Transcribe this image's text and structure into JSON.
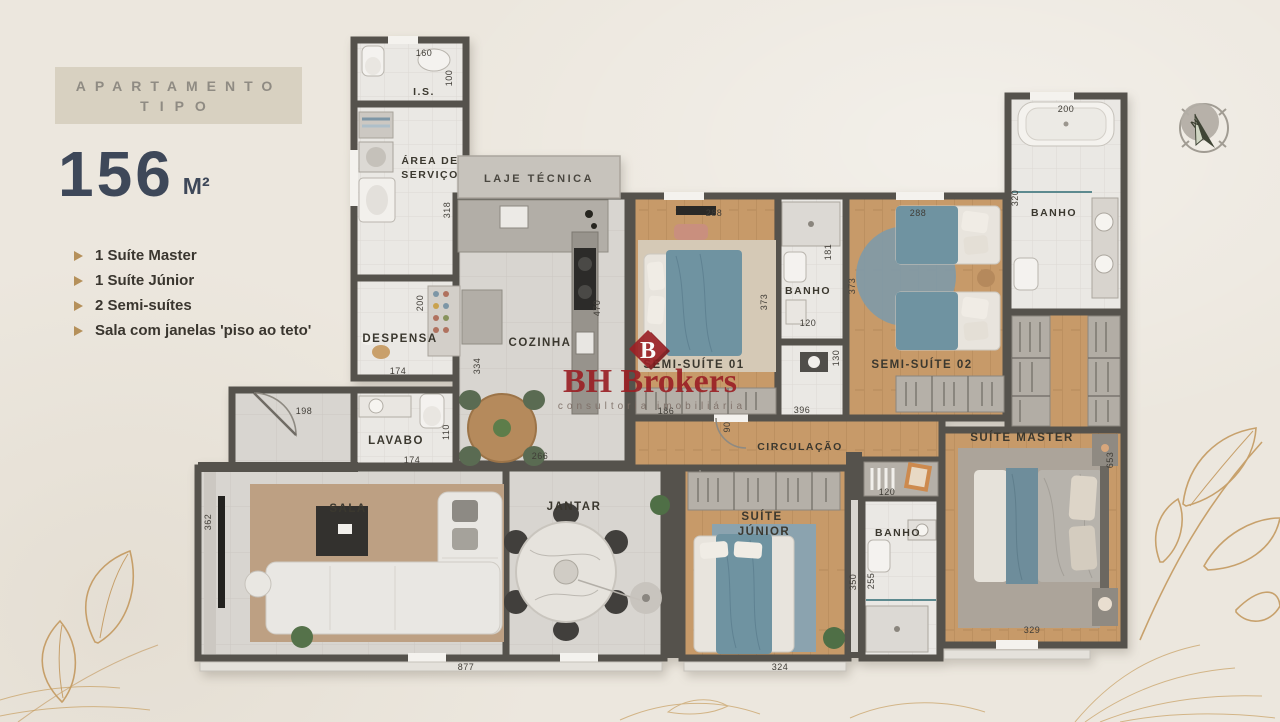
{
  "sidebar": {
    "banner": {
      "line1": "APARTAMENTO",
      "line2": "TIPO"
    },
    "area": {
      "value": "156",
      "unit": "M²"
    },
    "features": [
      {
        "label": "1 Suíte Master"
      },
      {
        "label": "1 Suíte Júnior"
      },
      {
        "label": "2 Semi-suítes"
      },
      {
        "label": "Sala com janelas 'piso ao teto'"
      }
    ]
  },
  "logo": {
    "monogram": "B",
    "name": "BH Brokers",
    "tagline": "consultoria imobiliária"
  },
  "compass": {
    "north": "N"
  },
  "plan": {
    "rooms": {
      "is": "I.S.",
      "area_servico_1": "ÁREA DE",
      "area_servico_2": "SERVIÇO",
      "laje_tecnica": "LAJE TÉCNICA",
      "despensa": "DESPENSA",
      "cozinha": "COZINHA",
      "lavabo": "LAVABO",
      "sala": "SALA",
      "jantar": "JANTAR",
      "semi_suite_01": "SEMI-SUÍTE 01",
      "semi_suite_02": "SEMI-SUÍTE 02",
      "banho_semi": "BANHO",
      "banho_master": "BANHO",
      "banho_junior": "BANHO",
      "circulacao": "CIRCULAÇÃO",
      "suite_master": "SUÍTE MASTER",
      "suite_junior_1": "SUÍTE",
      "suite_junior_2": "JÚNIOR"
    },
    "dimensions": {
      "is_width": "160",
      "is_depth": "100",
      "servico_height": "318",
      "despensa_height": "200",
      "despensa_width": "174",
      "cozinha_height": "334",
      "cozinha_counter": "470",
      "hall_width": "198",
      "lavabo_depth": "110",
      "lavabo_width": "174",
      "cozinha_width": "266",
      "sala_depth": "362",
      "sala_width": "877",
      "semi01_width": "288",
      "semi01_height": "373",
      "banho_semi_depth": "181",
      "banho_semi_width": "120",
      "hall_semi_depth": "130",
      "semi01_bottom": "186",
      "semi01_door": "90",
      "circulacao_width": "396",
      "semi02_height": "373",
      "semi02_width": "288",
      "banho_master_depth": "320",
      "banho_master_width": "200",
      "junior_closet": "120",
      "junior_height": "350",
      "banho_junior_height": "255",
      "junior_width": "324",
      "master_height": "653",
      "master_width": "329"
    }
  },
  "palette": {
    "background": "#ece7de",
    "wall": "#55524c",
    "wood_floor": "#c79a69",
    "teal_fabric": "#6f93a1",
    "gold_accent": "#bf9050",
    "logo_red": "#9b2126",
    "title_blue": "#3e4859"
  }
}
